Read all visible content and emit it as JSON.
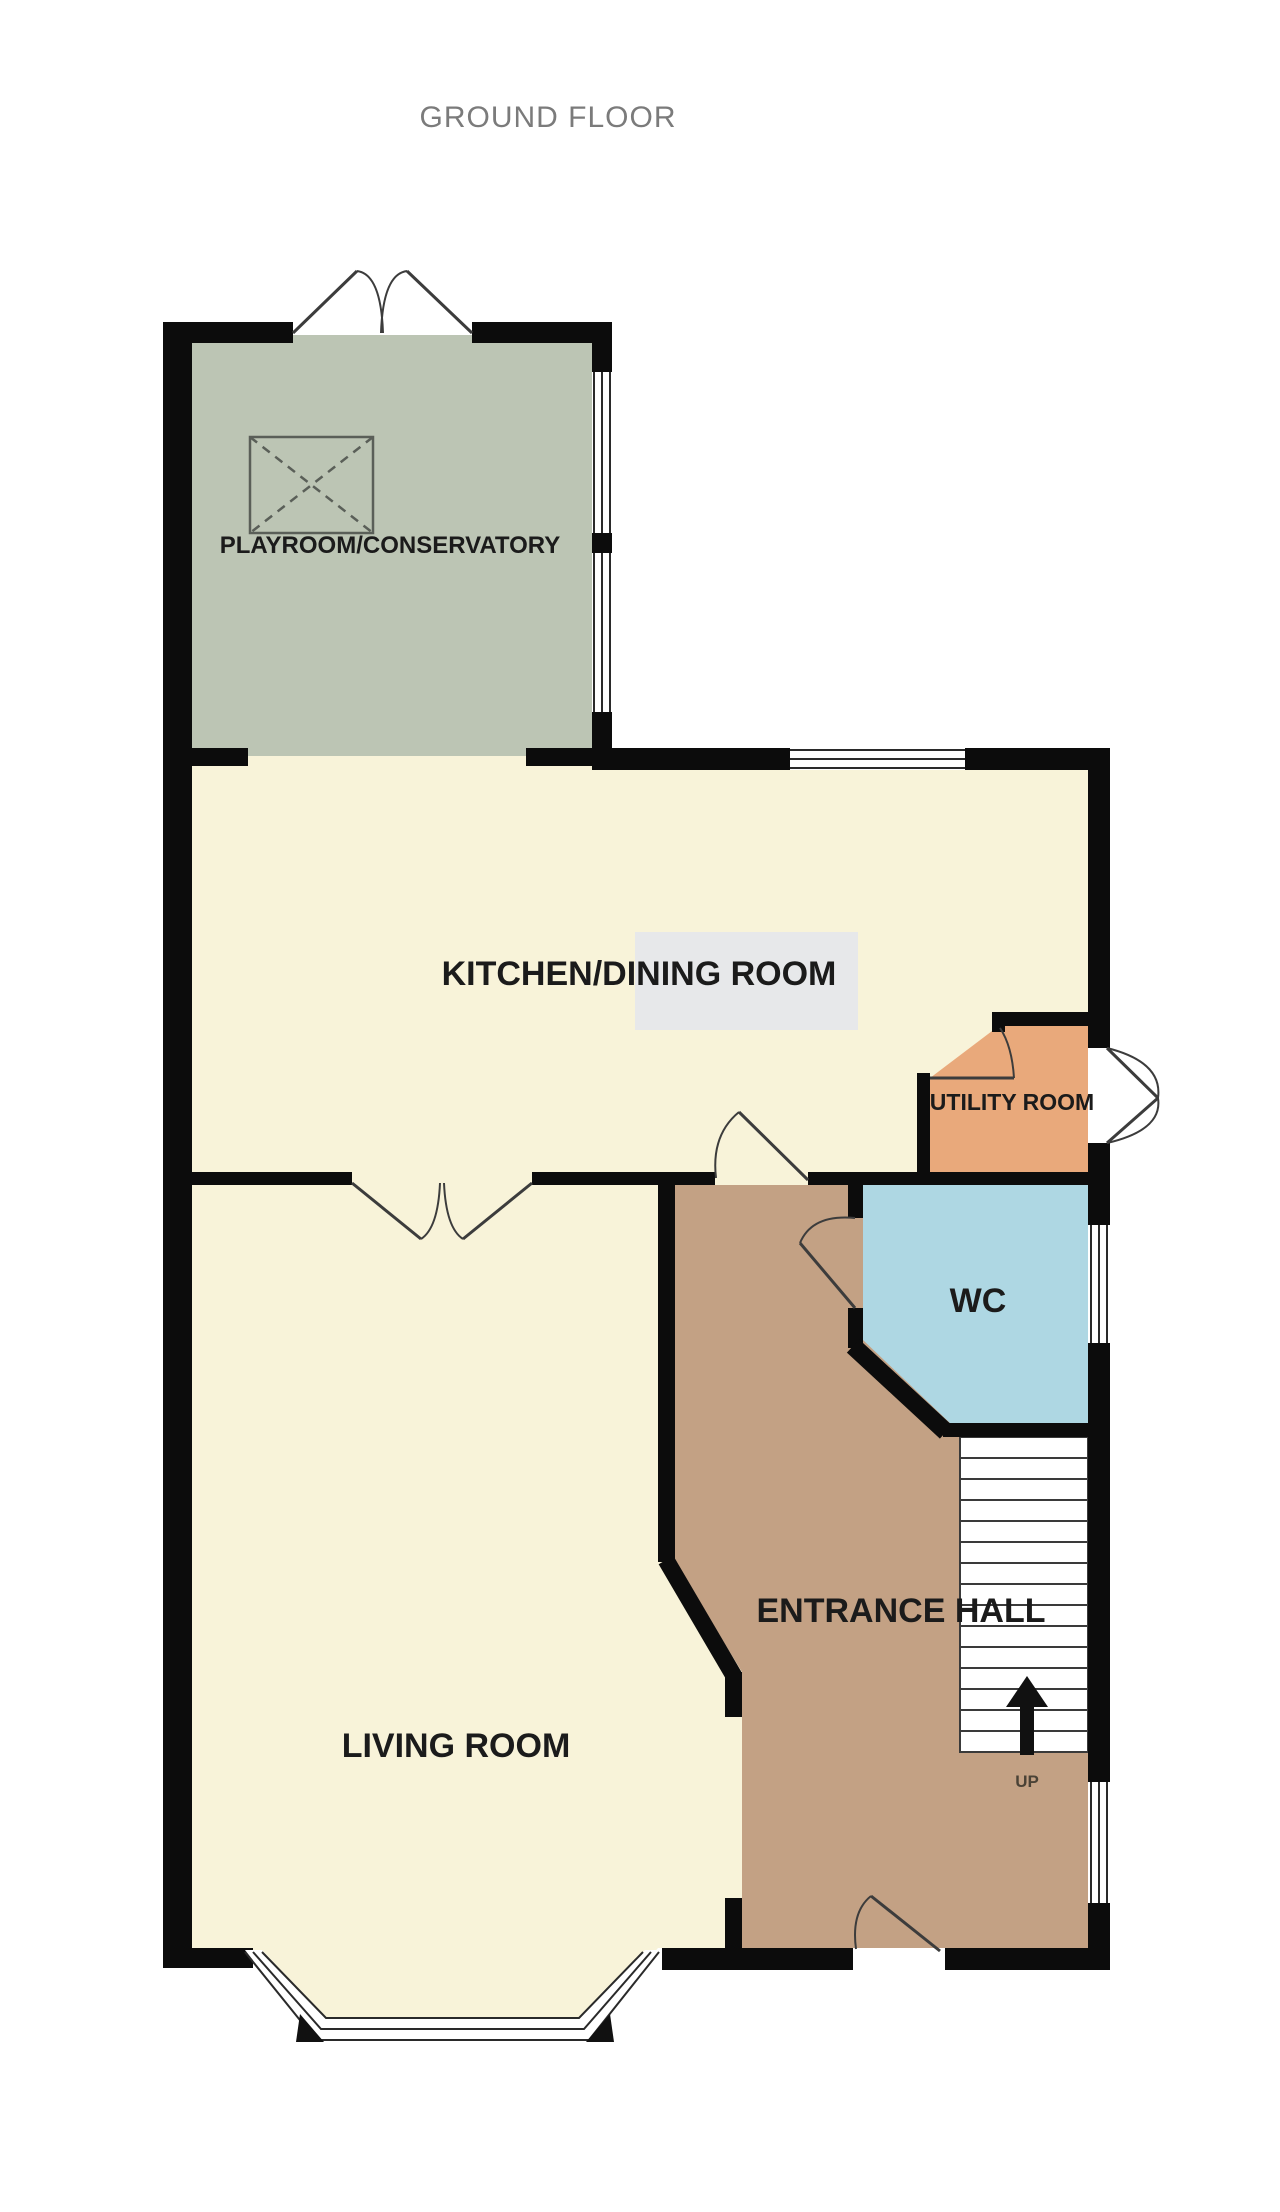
{
  "title": "GROUND FLOOR",
  "rooms": {
    "conservatory": {
      "label": "PLAYROOM/CONSERVATORY"
    },
    "kitchen": {
      "label": "KITCHEN/DINING ROOM"
    },
    "utility": {
      "label": "UTILITY ROOM"
    },
    "wc": {
      "label": "WC"
    },
    "hall": {
      "label": "ENTRANCE HALL"
    },
    "living": {
      "label": "LIVING ROOM"
    }
  },
  "stairs": {
    "direction_label": "UP",
    "tread_count": 14
  },
  "colors": {
    "wall": "#0c0c0c",
    "line": "#3c3c3c",
    "paper": "#ffffff",
    "cream": "#f8f3d9",
    "green": "#bcc5b4",
    "brown": "#c3a184",
    "orange": "#e9a97b",
    "blue": "#aed7e3",
    "graybox": "#e7e8ea",
    "title": "#7b7b7b",
    "label": "#1b1b1b",
    "uptext": "#4a4236"
  }
}
